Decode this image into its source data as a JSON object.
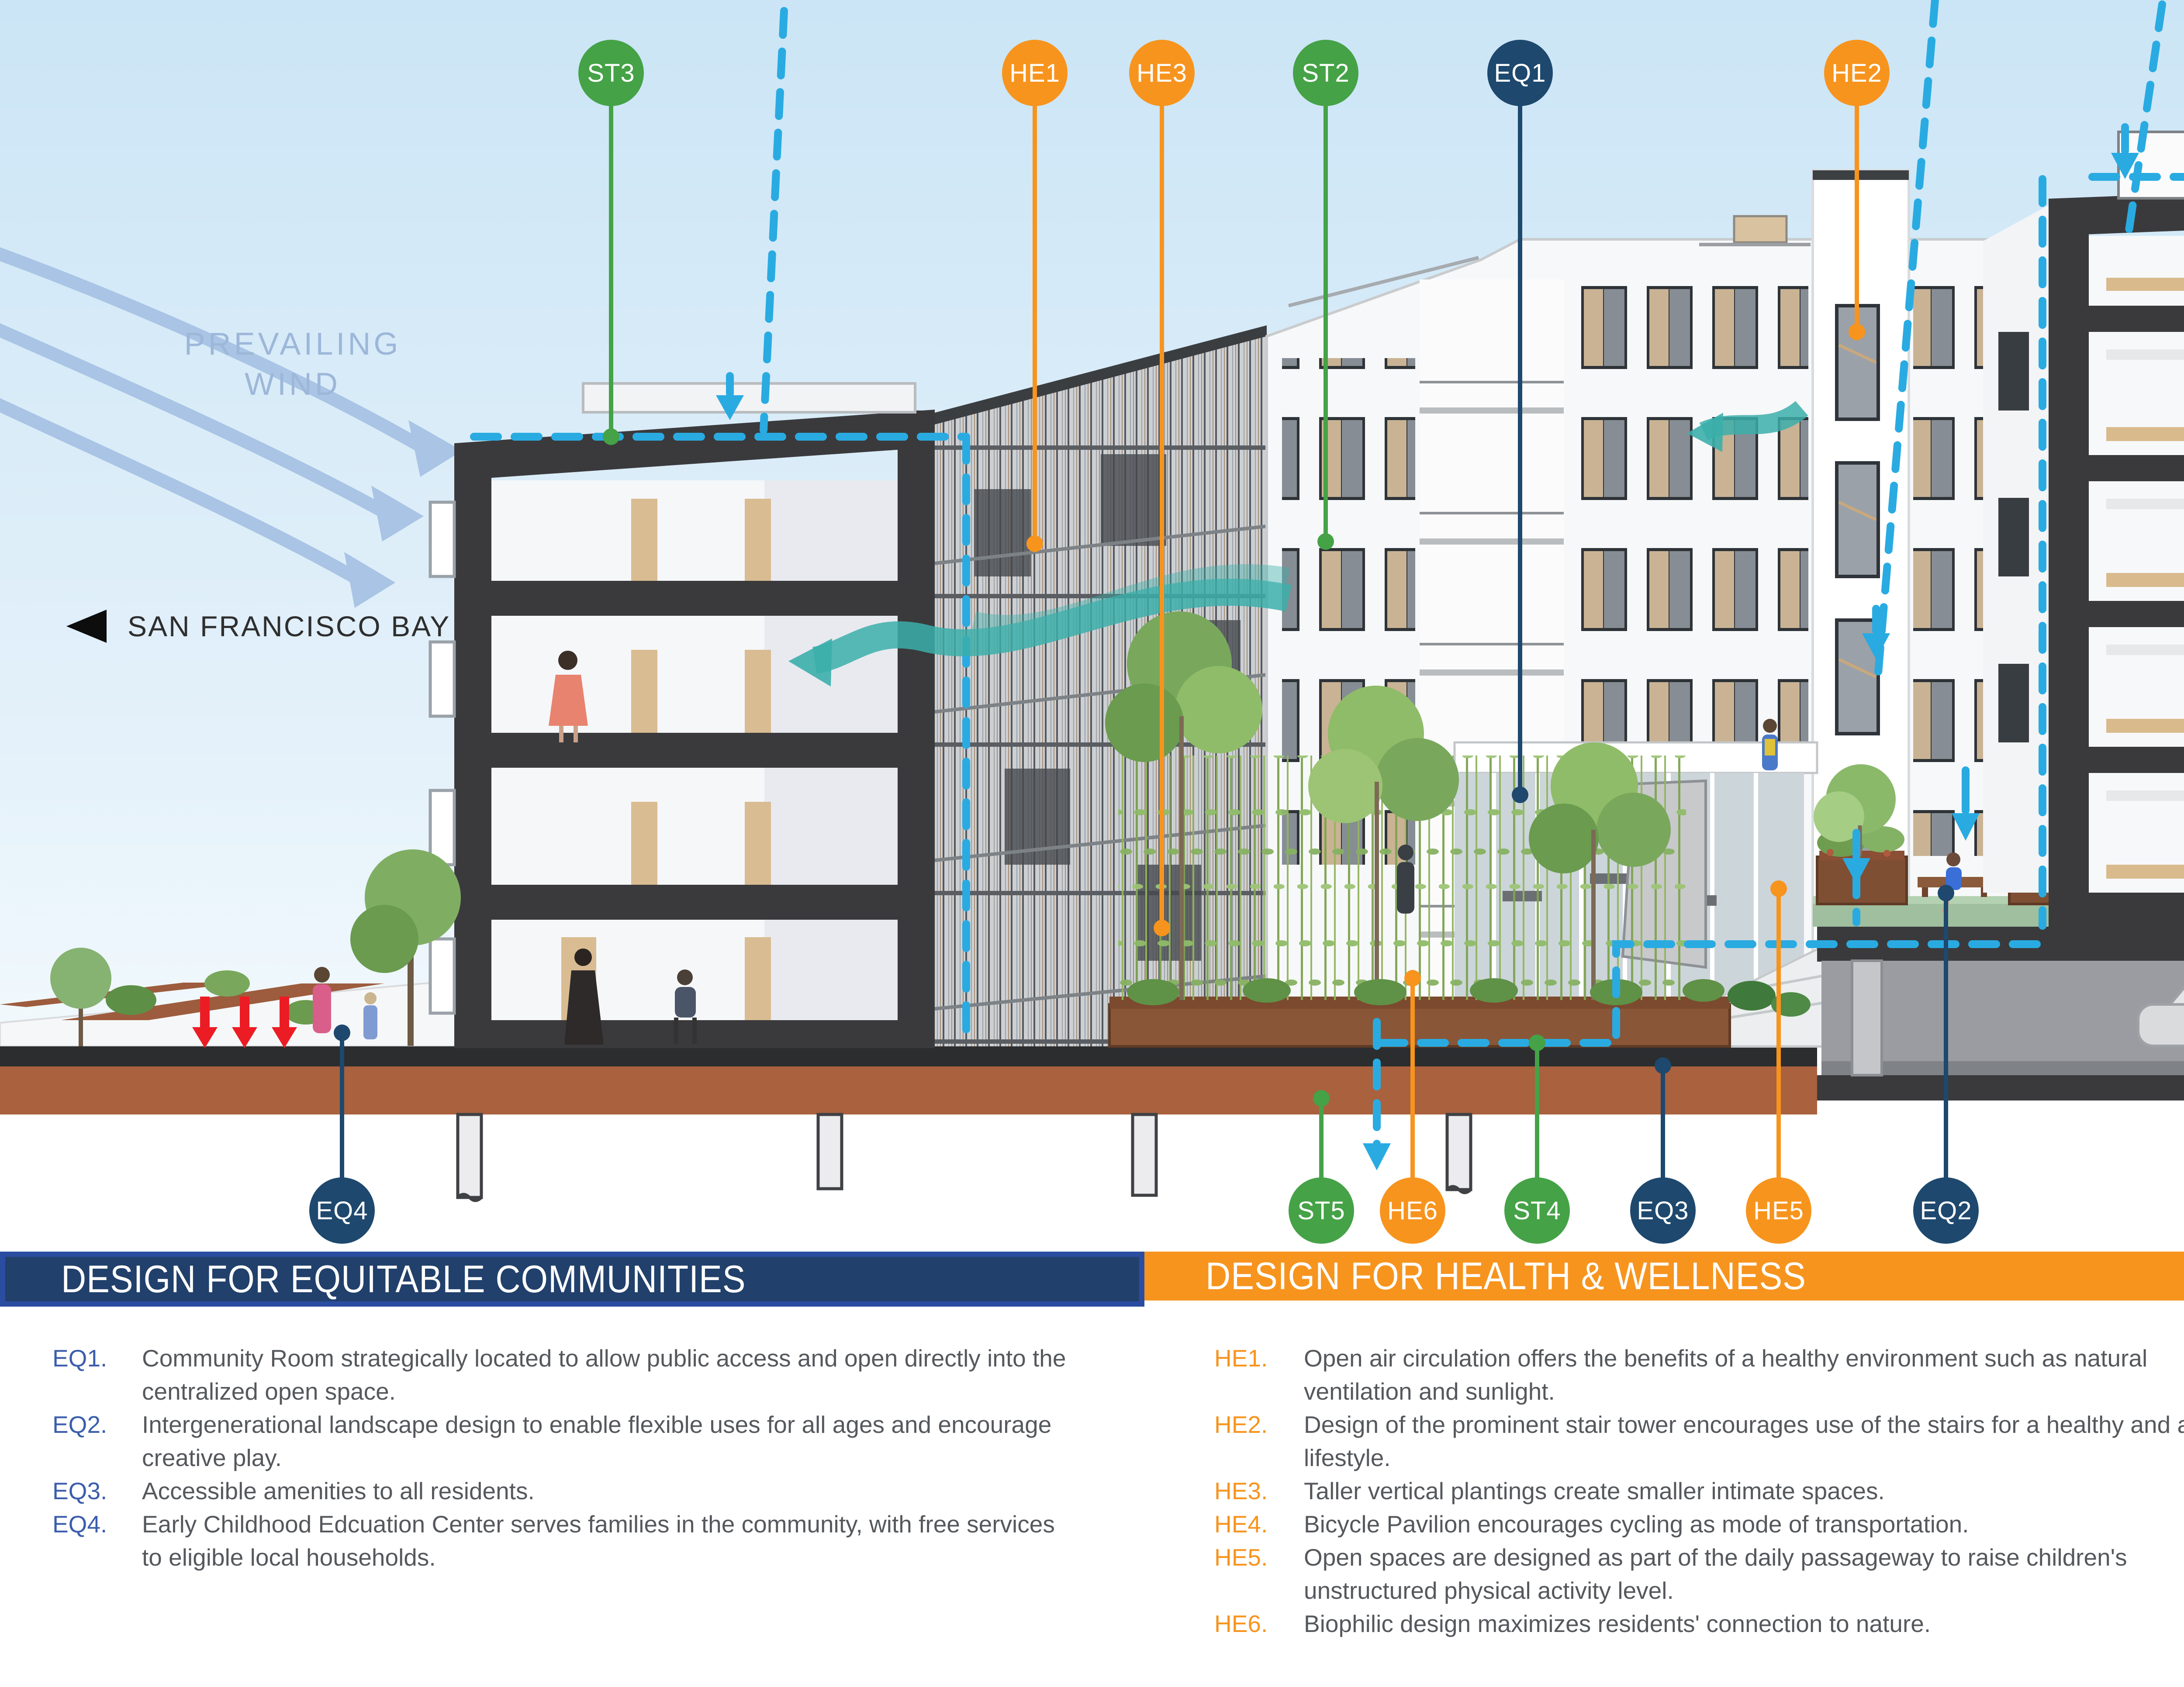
{
  "direction_labels": {
    "prevailing_wind": "PREVAILING WIND",
    "san_francisco_bay": "SAN FRANCISCO BAY",
    "inland": "INLAND"
  },
  "callouts": {
    "st3": "ST3",
    "he1": "HE1",
    "he3": "HE3",
    "st2": "ST2",
    "eq1": "EQ1",
    "he2": "HE2",
    "eq4": "EQ4",
    "st5": "ST5",
    "he6": "HE6",
    "st4": "ST4",
    "eq3": "EQ3",
    "he5": "HE5",
    "eq2": "EQ2",
    "st1": "ST1",
    "he4": "HE4"
  },
  "sections": {
    "eq": {
      "title": "DESIGN FOR EQUITABLE COMMUNITIES",
      "accent_color": "#21406b",
      "items": [
        {
          "code": "EQ1.",
          "text": "Community Room strategically located to allow public access and open directly into the centralized open space."
        },
        {
          "code": "EQ2.",
          "text": "Intergenerational landscape design to enable flexible uses for all ages and encourage creative play."
        },
        {
          "code": "EQ3.",
          "text": "Accessible amenities to all residents."
        },
        {
          "code": "EQ4.",
          "text": "Early Childhood Edcuation Center serves families in the community, with free services to eligible local households."
        }
      ]
    },
    "he": {
      "title": "DESIGN FOR HEALTH & WELLNESS",
      "accent_color": "#f7941e",
      "items": [
        {
          "code": "HE1.",
          "text": "Open air circulation offers the benefits of a healthy environment such as natural ventilation and sunlight."
        },
        {
          "code": "HE2.",
          "text": "Design of the prominent stair tower encourages use of the stairs for a healthy and active lifestyle."
        },
        {
          "code": "HE3.",
          "text": "Taller vertical plantings create smaller intimate spaces."
        },
        {
          "code": "HE4.",
          "text": "Bicycle Pavilion encourages cycling as mode of transportation."
        },
        {
          "code": "HE5.",
          "text": "Open spaces are designed as part of the daily passageway to raise children's unstructured physical activity level."
        },
        {
          "code": "HE6.",
          "text": "Biophilic design maximizes residents' connection to nature."
        }
      ]
    },
    "st": {
      "title": "DESIGN FOR SUSTAINABILITY & RESILIENCE",
      "accent_color": "#4aa84b",
      "items": [
        {
          "code": "ST1.",
          "text": "Project is built on previously developed brownfield site."
        },
        {
          "code": "ST2.",
          "text": "Breezeway and outdoor circulation reduces reliance on mechanical ventilation."
        },
        {
          "code": "ST3.",
          "text": "Well-sheltered central courtyards from strong winds from the Bay by building masses and vertical bamboo planting."
        },
        {
          "code": "ST4.",
          "text": "All stormwater is routed through flow-through planters."
        },
        {
          "code": "ST5.",
          "text": "Entire mid-block courtyard is built on a structural slab so that all mid-block access points will be stable and not interrupted by settlement."
        }
      ]
    }
  },
  "colors": {
    "equity_navy": "#1e486e",
    "health_orange": "#f7941e",
    "sustainability_green": "#45a247",
    "water_dashed_blue": "#29abe2",
    "ventilation_teal": "#3bafab",
    "load_arrow_red": "#ec1c24",
    "wind_arrow_blue": "#a9c4e4",
    "soil_brown": "#a9613e",
    "building_charcoal": "#3a3a3c"
  }
}
